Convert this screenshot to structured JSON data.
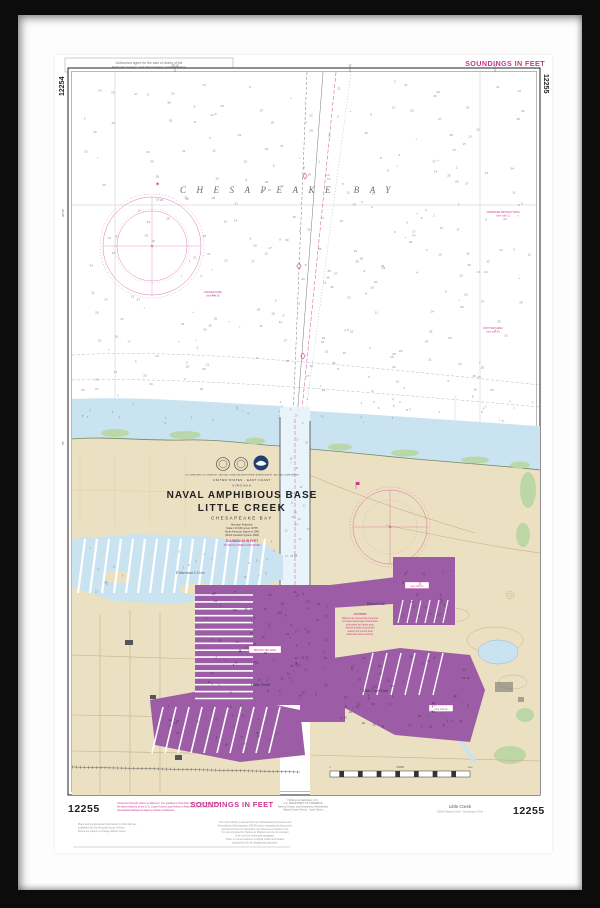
{
  "chart": {
    "number": "12255",
    "adjoining_left": "12254",
    "adjoining_right": "12255",
    "soundings_top": "SOUNDINGS IN FEET",
    "soundings_bottom": "SOUNDINGS IN FEET"
  },
  "title_block": {
    "agency_line": "U.S. DEPARTMENT OF COMMERCE · NATIONAL OCEANIC AND ATMOSPHERIC ADMINISTRATION · NATIONAL OCEAN SERVICE",
    "region": "UNITED STATES - EAST COAST",
    "state": "VIRGINIA",
    "title_line1": "NAVAL AMPHIBIOUS BASE",
    "title_line2": "LITTLE CREEK",
    "subtitle": "CHESAPEAKE BAY",
    "projection": "Mercator Projection",
    "scale": "Scale 1:10,000 at Lat. 36°55'",
    "datum": "North American Datum of 1983",
    "datum2": "(World Geodetic System 1984)",
    "soundings": "SOUNDINGS IN FEET",
    "soundings2": "AT MEAN LOWER LOW WATER"
  },
  "water_labels": {
    "bay": "CHESAPEAKE BAY",
    "fishermans_cove": "Fisherman's Cove",
    "desert_cove": "Desert Cove",
    "little_creek_cove": "Little Creek Cove",
    "harbor": "Little Creek"
  },
  "graticule": {
    "top": [
      "76°12'",
      "11'",
      "10'"
    ],
    "left": [
      "36°56'",
      "55'"
    ]
  },
  "scale_bar": {
    "unit": "YARDS",
    "ticks": [
      "0",
      "500",
      "1000"
    ]
  },
  "notes": {
    "top_box": [
      "Authorized agent for the sale of charts of the",
      "National Oceanic and Atmospheric Administration"
    ],
    "caution_title": "CAUTION",
    "caution_lines": [
      "Mariners are warned that numerous",
      "unmarked submerged obstructions",
      "exist within the harbor area.",
      "Vessels should proceed with",
      "caution and consult local",
      "authorities before entering."
    ],
    "restricted_boxes": [
      "RESTRICTED AREA",
      "(see note A)",
      "(see note F)"
    ],
    "note_left": [
      "DANGER ZONE",
      "(see note D)"
    ],
    "note_right_mid": [
      "FISH TRAP AREA",
      "(see note E)"
    ],
    "note_right_top": [
      "UNMARKED OBSTRUCTIONS",
      "(see note C)"
    ]
  },
  "margins": {
    "magenta_note": [
      "Corrected through Notice to Mariners. For updates to this chart the mariner should consult",
      "the latest editions of the U.S. Coast Guard Local Notice to Mariners and the National",
      "Geospatial-Intelligence Agency Notice to Mariners."
    ],
    "left_note": [
      "Plans and supplemental information for this chart are",
      "available from the National Ocean Service.",
      "Prices are subject to change without notice."
    ],
    "edition_note": [
      "Published at Washington, D.C.",
      "U.S. DEPARTMENT OF COMMERCE",
      "National Oceanic and Atmospheric Administration",
      "National Ocean Service · Coast Survey"
    ],
    "caption_title": "Little Creek",
    "caption_sub": "NOAA Nautical Chart · Soundings in Feet",
    "disclaimer": [
      "This chart display is derived from an official National Oceanic and",
      "Atmospheric Administration (NOAA) raster navigational chart and is",
      "reproduced here for decorative and reference purposes only.",
      "It is not corrected for Notices to Mariners and is not intended",
      "to be used for real-world navigation.",
      "Refer to current editions of official charts and related",
      "publications for all navigational purposes."
    ]
  }
}
